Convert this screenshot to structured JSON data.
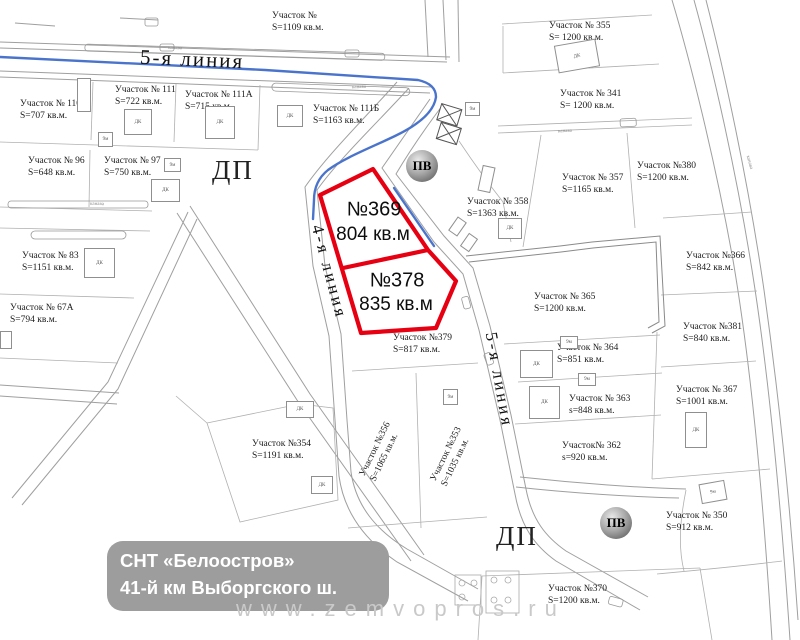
{
  "sign": {
    "line1": "СНТ «Белоостров»",
    "line2": "41-й км Выборгского ш."
  },
  "watermark": "www.zemvopros.ru",
  "roads": {
    "top_line": "5-я линия",
    "left_line": "4-я линия",
    "right_line": "5-я линия"
  },
  "zones": {
    "dp1": "ДП",
    "dp2": "ДП",
    "pv1": "ПВ",
    "pv2": "ПВ"
  },
  "highlight": [
    {
      "number": "№369",
      "area": "804 кв.м",
      "x": 374,
      "y": 210,
      "area_x": 373,
      "area_y": 235
    },
    {
      "number": "№378",
      "area": "835 кв.м",
      "x": 397,
      "y": 281,
      "area_x": 396,
      "area_y": 305
    }
  ],
  "plots": [
    {
      "name": "Участок № 110",
      "area": "S=707 кв.м.",
      "x": 20,
      "y": 98
    },
    {
      "name": "Участок № 111",
      "area": "S=722 кв.м.",
      "x": 115,
      "y": 84
    },
    {
      "name": "Участок № 111А",
      "area": "S=715 кв.м.",
      "x": 185,
      "y": 89
    },
    {
      "name": "Участок №",
      "area": "S=1109 кв.м.",
      "x": 272,
      "y": 10
    },
    {
      "name": "Участок № 111Б",
      "area": "S=1163 кв.м.",
      "x": 313,
      "y": 103
    },
    {
      "name": "Участок № 355",
      "area": "S= 1200 кв.м.",
      "x": 549,
      "y": 20
    },
    {
      "name": "Участок № 341",
      "area": "S= 1200 кв.м.",
      "x": 560,
      "y": 88
    },
    {
      "name": "Участок № 96",
      "area": "S=648 кв.м.",
      "x": 28,
      "y": 155
    },
    {
      "name": "Участок № 97",
      "area": "S=750 кв.м.",
      "x": 104,
      "y": 155
    },
    {
      "name": "Участок № 357",
      "area": "S=1165 кв.м.",
      "x": 562,
      "y": 172
    },
    {
      "name": "Участок №380",
      "area": "S=1200 кв.м.",
      "x": 637,
      "y": 160
    },
    {
      "name": "Участок № 358",
      "area": "S=1363 кв.м.",
      "x": 467,
      "y": 196
    },
    {
      "name": "Участок №366",
      "area": "S=842 кв.м.",
      "x": 686,
      "y": 250
    },
    {
      "name": "Участок № 83",
      "area": "S=1151 кв.м.",
      "x": 22,
      "y": 250
    },
    {
      "name": "Участок № 67А",
      "area": "S=794 кв.м.",
      "x": 10,
      "y": 302
    },
    {
      "name": "Участок № 365",
      "area": "S=1200 кв.м.",
      "x": 534,
      "y": 291
    },
    {
      "name": "Участок №381",
      "area": "S=840 кв.м.",
      "x": 683,
      "y": 321
    },
    {
      "name": "Участок №379",
      "area": "S=817 кв.м.",
      "x": 393,
      "y": 332
    },
    {
      "name": "Участок № 364",
      "area": "S=851 кв.м.",
      "x": 557,
      "y": 342
    },
    {
      "name": "Участок № 363",
      "area": "s=848 кв.м.",
      "x": 569,
      "y": 393
    },
    {
      "name": "Участок № 367",
      "area": "S=1001 кв.м.",
      "x": 676,
      "y": 384
    },
    {
      "name": "Участок№ 362",
      "area": "s=920 кв.м.",
      "x": 562,
      "y": 440
    },
    {
      "name": "Участок №356",
      "area": "S=1065 кв.м.",
      "x": 381,
      "y": 452,
      "rot": -64,
      "center": true
    },
    {
      "name": "Участок №353",
      "area": "S=1035 кв.м.",
      "x": 452,
      "y": 457,
      "rot": -64,
      "center": true
    },
    {
      "name": "Участок №354",
      "area": "S=1191 кв.м.",
      "x": 252,
      "y": 438
    },
    {
      "name": "Участок № 350",
      "area": "S=912 кв.м.",
      "x": 666,
      "y": 510
    },
    {
      "name": "Участок №370",
      "area": "S=1200 кв.м.",
      "x": 548,
      "y": 583
    }
  ],
  "buildings": [
    {
      "x": 77,
      "y": 78,
      "w": 12,
      "h": 32,
      "label": ""
    },
    {
      "x": 124,
      "y": 109,
      "w": 26,
      "h": 24,
      "label": "ДК"
    },
    {
      "x": 205,
      "y": 106,
      "w": 28,
      "h": 31,
      "label": "ДК"
    },
    {
      "x": 277,
      "y": 105,
      "w": 24,
      "h": 20,
      "label": "ДК"
    },
    {
      "x": 556,
      "y": 42,
      "w": 40,
      "h": 26,
      "label": "ДК",
      "rot": -10
    },
    {
      "x": 498,
      "y": 218,
      "w": 22,
      "h": 19,
      "label": "ДК"
    },
    {
      "x": 84,
      "y": 248,
      "w": 29,
      "h": 28,
      "label": "ДК"
    },
    {
      "x": 98,
      "y": 132,
      "w": 13,
      "h": 13,
      "label": "9м"
    },
    {
      "x": 164,
      "y": 158,
      "w": 15,
      "h": 12,
      "label": "9м"
    },
    {
      "x": 151,
      "y": 179,
      "w": 27,
      "h": 21,
      "label": "ДК"
    },
    {
      "x": 286,
      "y": 401,
      "w": 26,
      "h": 15,
      "label": "ДК"
    },
    {
      "x": 311,
      "y": 476,
      "w": 20,
      "h": 16,
      "label": "ДК"
    },
    {
      "x": 520,
      "y": 350,
      "w": 31,
      "h": 26,
      "label": "ДК"
    },
    {
      "x": 529,
      "y": 386,
      "w": 29,
      "h": 31,
      "label": "ДК"
    },
    {
      "x": 685,
      "y": 412,
      "w": 20,
      "h": 34,
      "label": "ДК"
    },
    {
      "x": 700,
      "y": 482,
      "w": 24,
      "h": 18,
      "label": "9м",
      "rot": -10
    },
    {
      "x": 465,
      "y": 102,
      "w": 13,
      "h": 12,
      "label": "9м"
    },
    {
      "x": 443,
      "y": 389,
      "w": 13,
      "h": 14,
      "label": "9м"
    },
    {
      "x": 560,
      "y": 336,
      "w": 16,
      "h": 11,
      "label": "9м"
    },
    {
      "x": 578,
      "y": 373,
      "w": 16,
      "h": 11,
      "label": "9м"
    },
    {
      "x": 449,
      "y": 221,
      "w": 15,
      "h": 9,
      "label": "",
      "rot": -55
    },
    {
      "x": 461,
      "y": 237,
      "w": 14,
      "h": 9,
      "label": "",
      "rot": -55
    },
    {
      "x": 480,
      "y": 166,
      "w": 11,
      "h": 24,
      "label": "",
      "rot": 12
    },
    {
      "x": 0,
      "y": 331,
      "w": 10,
      "h": 16,
      "label": ""
    }
  ],
  "road_annotations": [
    {
      "text": "канава",
      "x": 352,
      "y": 85,
      "rot": -2
    },
    {
      "text": "канава",
      "x": 90,
      "y": 202,
      "rot": 1
    },
    {
      "text": "канава",
      "x": 558,
      "y": 129,
      "rot": -3
    },
    {
      "text": "канава",
      "x": 168,
      "y": 46,
      "rot": 2
    },
    {
      "text": "канава",
      "x": 742,
      "y": 160,
      "rot": 75
    }
  ],
  "colors": {
    "highlight_red": "#e60012",
    "stream_blue": "#4a74cc",
    "sign_gray": "#9d9d9d",
    "watermark_gray": "#c9c9c9",
    "line_gray": "#9f9f9f"
  }
}
